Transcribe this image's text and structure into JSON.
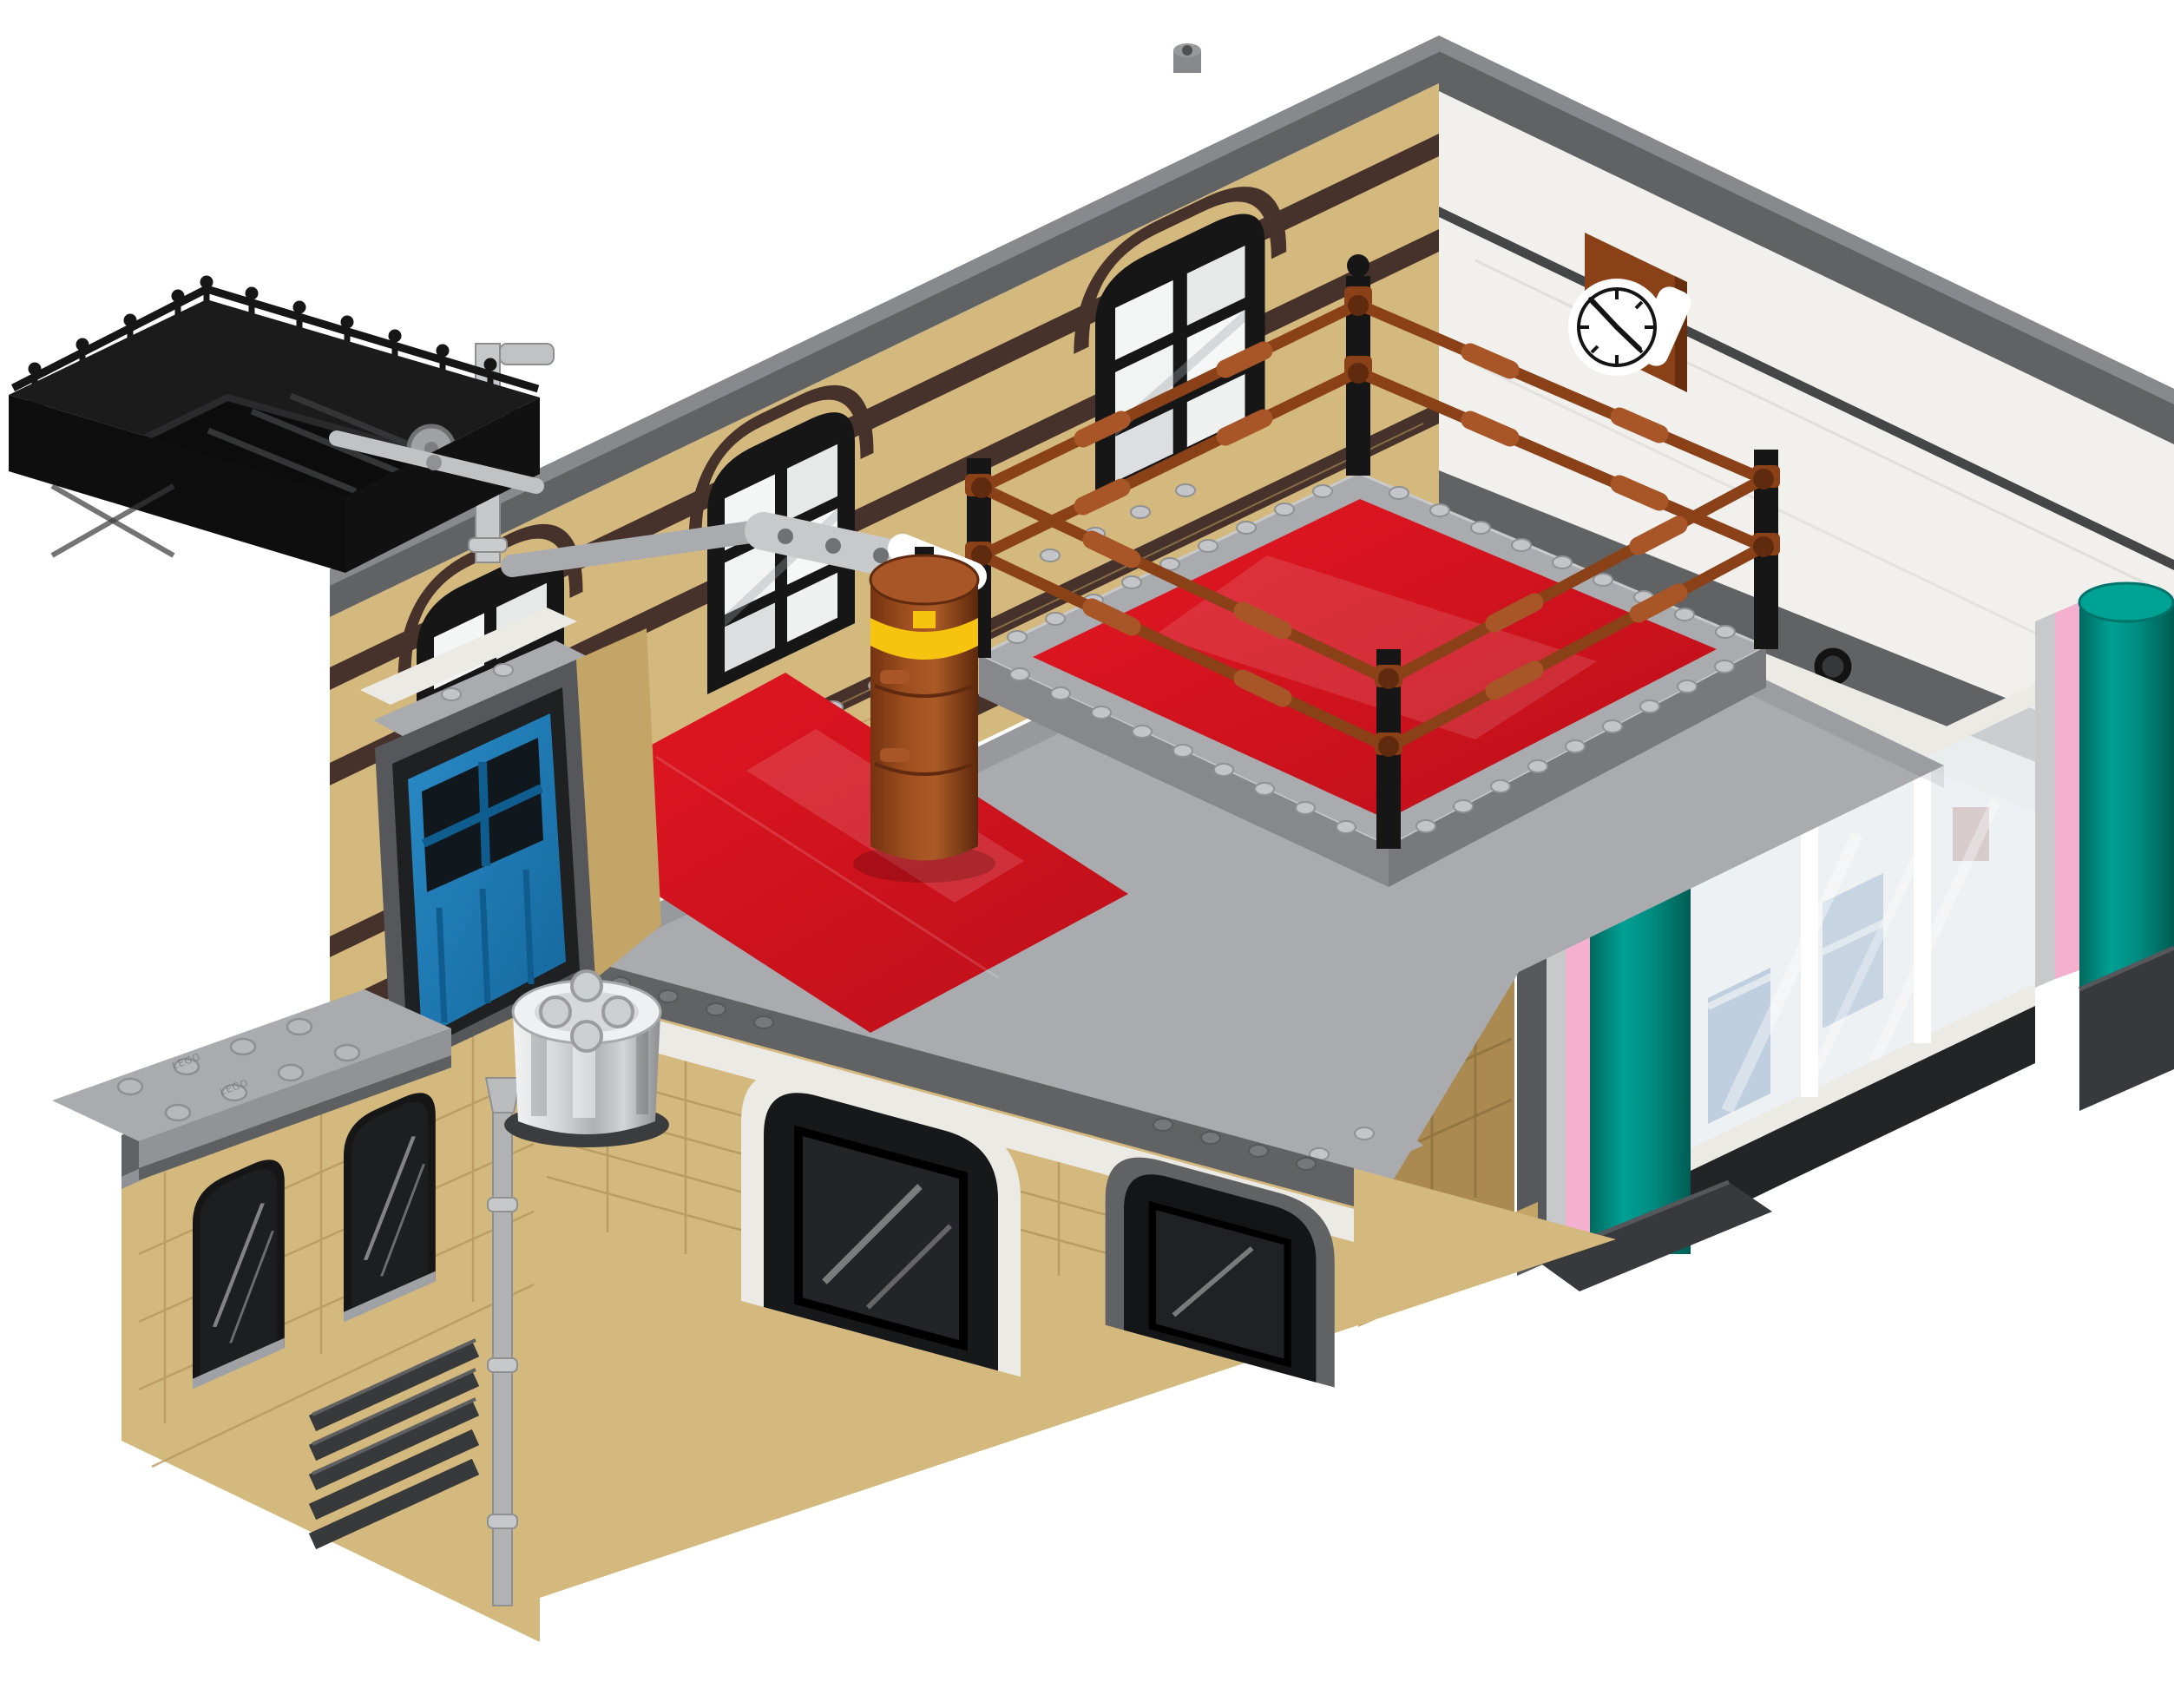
{
  "image": {
    "type": "product-photo",
    "subject": "LEGO modular building top-floor module - boxing gym interior with ring, punching bag, wall clock, rooftop fire-escape section and teal diner-facade columns",
    "background": "plain white"
  },
  "colors": {
    "bg": "#ffffff",
    "tan": "#d4b97e",
    "tan_dark": "#c3a567",
    "tan_line": "#b3955a",
    "dark_tan": "#ab8a52",
    "dark_tan_line": "#8f7340",
    "brown": "#46322a",
    "black": "#161616",
    "dgrey": "#606264",
    "dgrey_bevel": "#87898c",
    "dgrey_dark": "#494b4d",
    "lgrey": "#a9abae",
    "lgrey_light": "#c7c9cb",
    "lgrey_dark": "#8f9194",
    "white_wall": "#f1f0ec",
    "white_tiles": "#eceae5",
    "white": "#ffffff",
    "red": "#d7141f",
    "red_dark": "#aa0e16",
    "rust": "#8a4118",
    "rust_light": "#a85627",
    "rust_dark": "#5f2a0e",
    "yellow": "#f6c40f",
    "blue": "#1a7ab5",
    "blue_dark": "#0f5c8e",
    "teal": "#009184",
    "teal_light": "#00a294",
    "teal_dark": "#00746a",
    "pink": "#f3b1cf",
    "glass": "#e9edef",
    "glass_blue": "#2f67a5",
    "chrome_hi": "#eef0f1",
    "chrome_dark": "#8e9092",
    "base_dark": "#37393c"
  },
  "objects": {
    "stud_embossing": "LEGO",
    "clock": {
      "time_shown": "4:50",
      "face": "white",
      "mount": "reddish-brown square tile"
    },
    "boxing_ring": {
      "mat": "red",
      "ropes": "reddish-brown, 2 levels",
      "posts": 4,
      "platform": "light grey studded plates"
    },
    "punching_bag": {
      "body": "reddish-brown barrel",
      "band": "yellow",
      "arm": "light grey technic beam"
    },
    "walls": {
      "back_left": "tan with dark brown stripes and 3 arched windows",
      "back_right": "white with wall clock",
      "front": "tan brick with grey arches"
    },
    "facade": {
      "columns": "teal half-cylinders with pink and grey stripes",
      "windows": "clear glass with white frames"
    },
    "extras": [
      "black rooftop fire-escape with ornate railing",
      "blue door",
      "chrome canister",
      "silver downspout",
      "dark grey vent grille",
      "grey studded baseplates"
    ]
  }
}
